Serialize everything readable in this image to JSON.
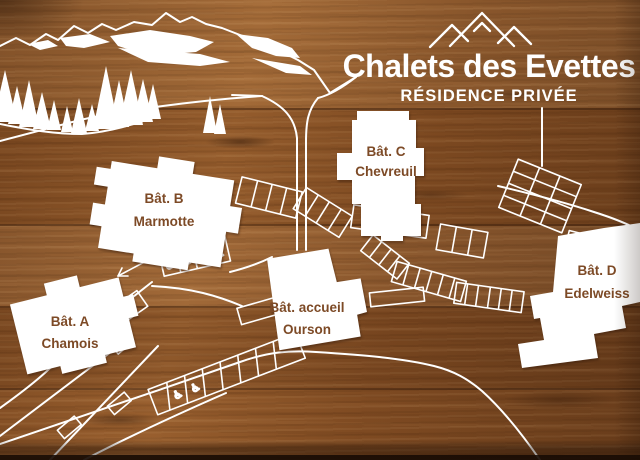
{
  "sign": {
    "title": "Chalets des Evettes",
    "subtitle": "RÉSIDENCE PRIVÉE"
  },
  "buildings": {
    "a": {
      "label": "Bât. A",
      "name": "Chamois"
    },
    "b": {
      "label": "Bât. B",
      "name": "Marmotte"
    },
    "c": {
      "label": "Bât. C",
      "name": "Chevreuil"
    },
    "d": {
      "label": "Bât. D",
      "name": "Edelweiss"
    },
    "accueil": {
      "label": "Bât. accueil",
      "name": "Ourson"
    }
  },
  "icons": {
    "wheelchair": "♿",
    "logo": "three-mountain-peaks"
  },
  "colors": {
    "wood": "#8a5226",
    "line": "#ffffff",
    "building_fill": "#ffffff",
    "label_text": "#7d4a26"
  }
}
